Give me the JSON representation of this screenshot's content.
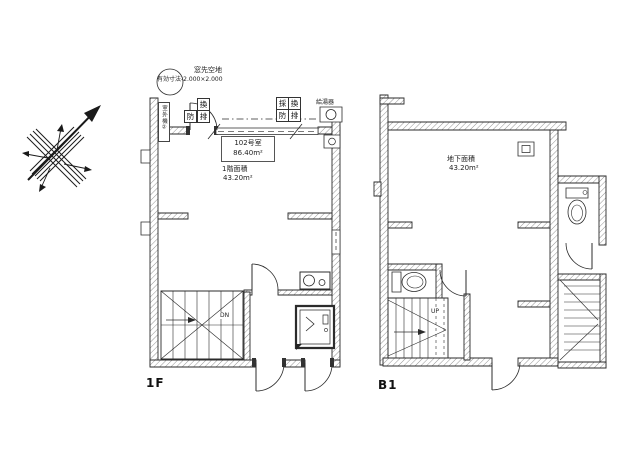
{
  "drawing": {
    "background": "#ffffff",
    "line_color": "#2b2b2b"
  },
  "floor_1f": {
    "title": "1F",
    "open_space_note": "窓先空地",
    "open_space_dimensions": "有効寸法-2.000×2.000",
    "outdoor_unit_label": "室外機②",
    "water_heater_label": "給湯器",
    "room_number": "102号室",
    "room_total_area": "86.40m²",
    "floor_area_label": "1階面積",
    "floor_area_value": "43.20m²",
    "stair_direction": "DN",
    "door_symbols": {
      "ventilation": "換",
      "fire": "防",
      "smoke": "排"
    },
    "symbol_grid": [
      "採",
      "換",
      "防",
      "排"
    ]
  },
  "floor_b1": {
    "title": "B1",
    "area_label": "地下面積",
    "area_value": "43.20m²",
    "stair_direction": "UP"
  }
}
